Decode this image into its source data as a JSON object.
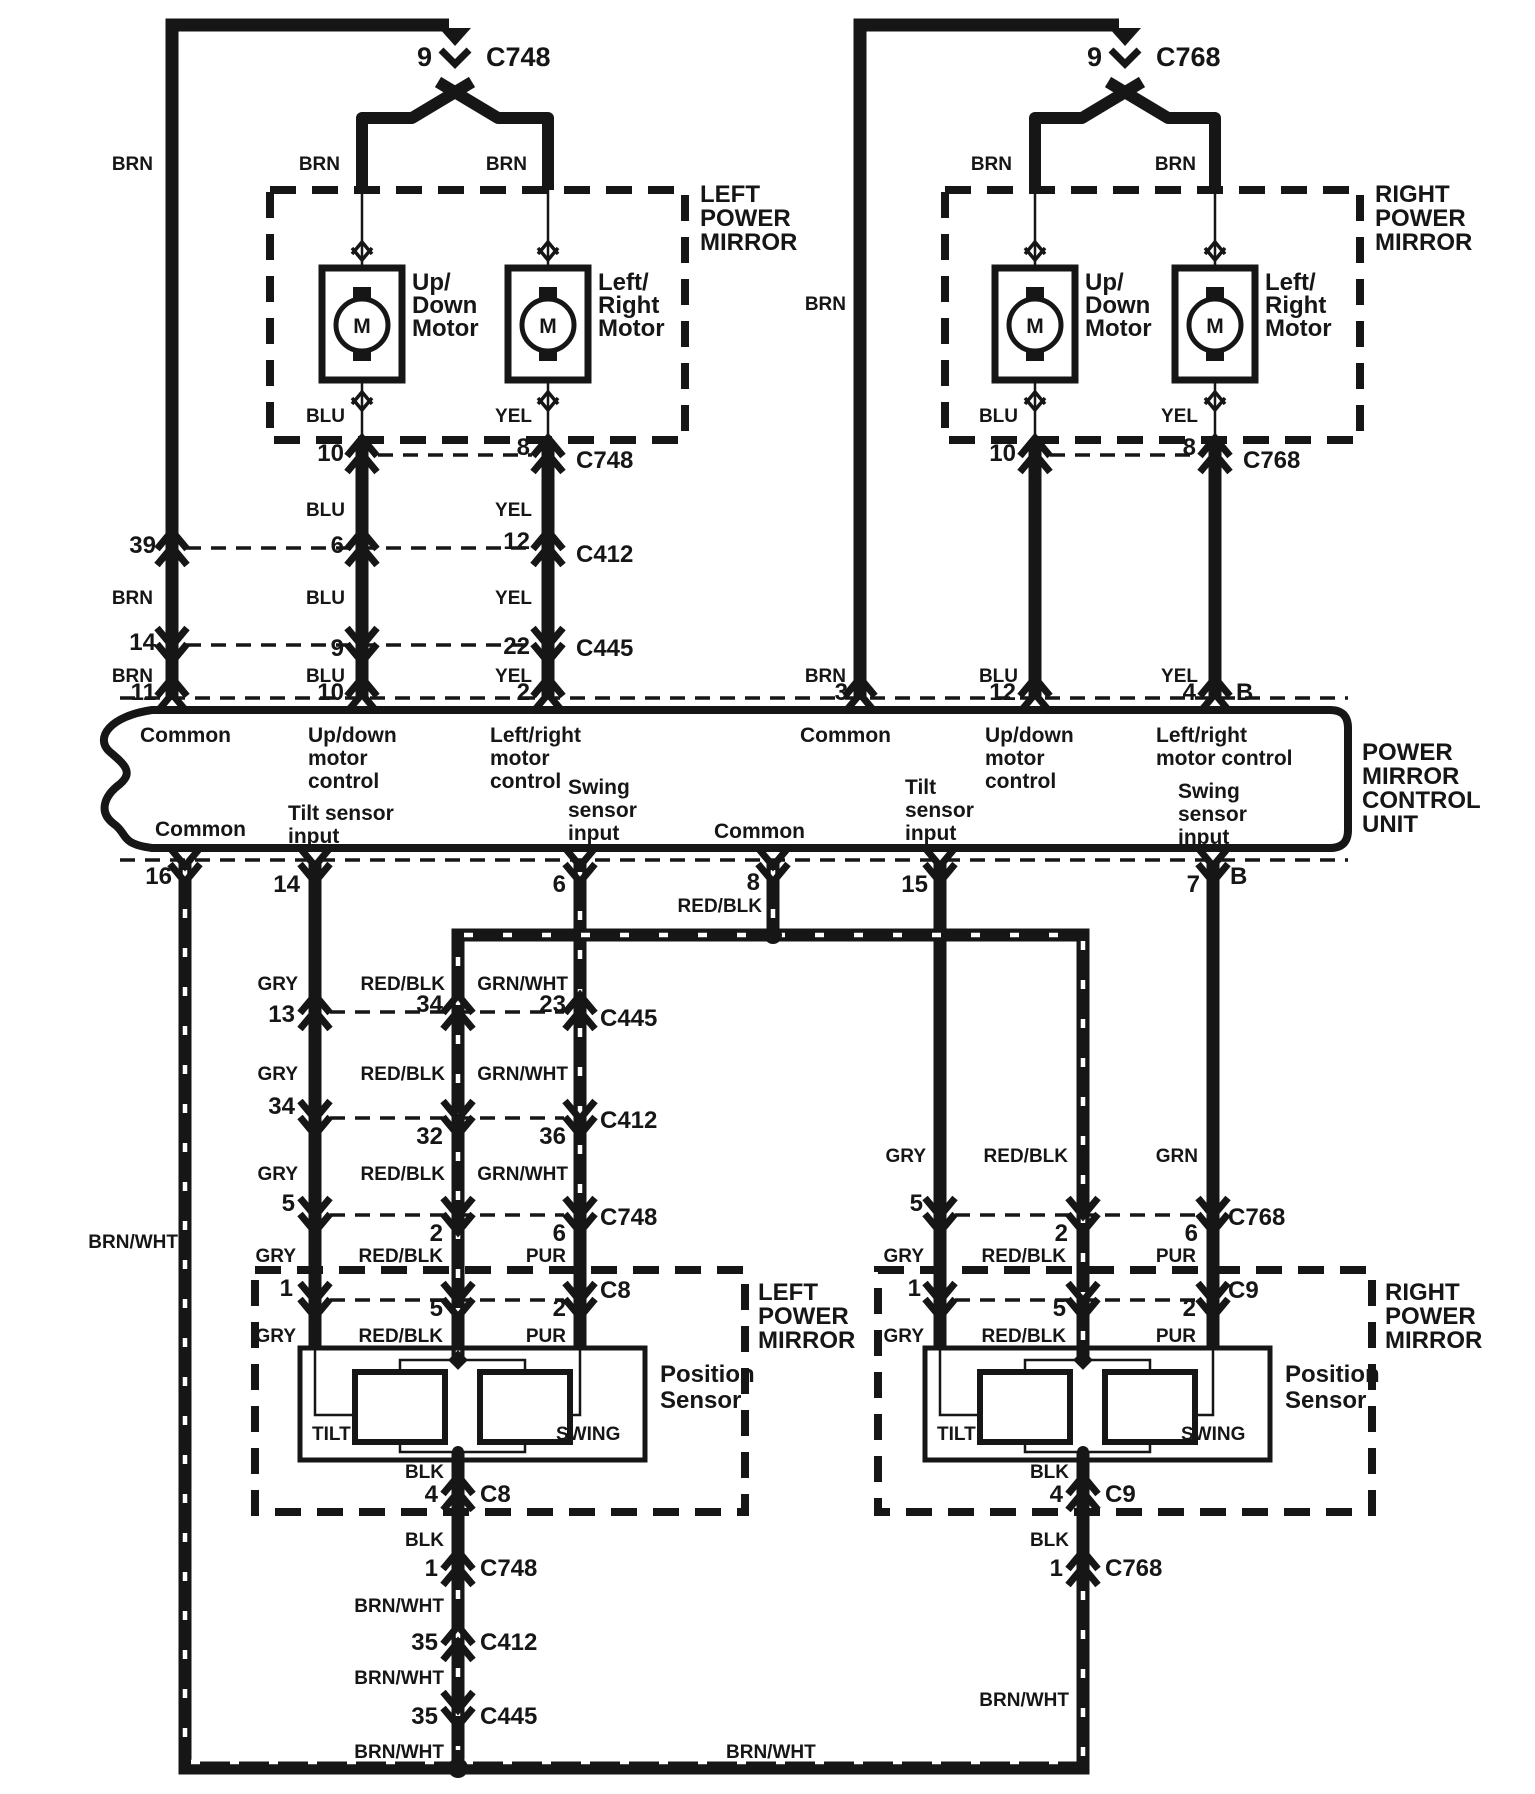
{
  "left_top": {
    "pin": "9",
    "connector": "C748",
    "feed_color": "BRN",
    "branch_left_color": "BRN",
    "branch_right_color": "BRN",
    "box_label": [
      "LEFT",
      "POWER",
      "MIRROR"
    ],
    "updown_motor": [
      "Up/",
      "Down",
      "Motor"
    ],
    "leftright_motor": [
      "Left/",
      "Right",
      "Motor"
    ],
    "motor_letter": "M"
  },
  "right_top": {
    "pin": "9",
    "connector": "C768",
    "feed_color": "BRN",
    "branch_left_color": "BRN",
    "branch_right_color": "BRN",
    "box_label": [
      "RIGHT",
      "POWER",
      "MIRROR"
    ],
    "updown_motor": [
      "Up/",
      "Down",
      "Motor"
    ],
    "leftright_motor": [
      "Left/",
      "Right",
      "Motor"
    ],
    "motor_letter": "M"
  },
  "left_rows": {
    "c748": {
      "colors": [
        "BLU",
        "YEL"
      ],
      "pins": [
        "10",
        "8"
      ],
      "name": "C748"
    },
    "c412": {
      "colors": [
        "BLU",
        "YEL"
      ],
      "pins": [
        "39",
        "6",
        "12"
      ],
      "name": "C412"
    },
    "c445": {
      "colors": [
        "BRN",
        "BLU",
        "YEL"
      ],
      "pins": [
        "14",
        "9",
        "22"
      ],
      "name": "C445"
    },
    "unit": {
      "colors": [
        "BRN",
        "BLU",
        "YEL"
      ],
      "pins": [
        "11",
        "10",
        "2"
      ]
    }
  },
  "right_rows": {
    "c768": {
      "colors": [
        "BLU",
        "YEL"
      ],
      "pins": [
        "10",
        "8"
      ],
      "name": "C768"
    },
    "unit": {
      "colors": [
        "BRN",
        "BLU",
        "YEL"
      ],
      "pins": [
        "3",
        "12",
        "4"
      ],
      "suffix": "B"
    }
  },
  "unit": {
    "title": [
      "POWER",
      "MIRROR",
      "CONTROL",
      "UNIT"
    ],
    "top_fn": {
      "common_l": "Common",
      "updown_l": [
        "Up/down",
        "motor",
        "control"
      ],
      "leftright_l": [
        "Left/right",
        "motor",
        "control"
      ],
      "common_r": "Common",
      "updown_r": [
        "Up/down",
        "motor",
        "control"
      ],
      "leftright_r": [
        "Left/right",
        "motor control"
      ]
    },
    "bottom_fn": {
      "common_l": "Common",
      "tilt_l": [
        "Tilt sensor",
        "input"
      ],
      "swing_l": [
        "Swing",
        "sensor",
        "input"
      ],
      "common_m": "Common",
      "tilt_r": [
        "Tilt",
        "sensor",
        "input"
      ],
      "swing_r": [
        "Swing",
        "sensor",
        "input"
      ]
    },
    "bottom_pins": {
      "p16": "16",
      "p14": "14",
      "p6": "6",
      "p8": "8",
      "p8_color": "RED/BLK",
      "p15": "15",
      "p7": "7",
      "suffix": "B"
    }
  },
  "left_lower": {
    "feed_color": "BRN/WHT",
    "c445": {
      "colors": [
        "GRY",
        "RED/BLK",
        "GRN/WHT"
      ],
      "pins": [
        "13",
        "34",
        "23"
      ],
      "name": "C445"
    },
    "c412": {
      "colors": [
        "GRY",
        "RED/BLK",
        "GRN/WHT"
      ],
      "pins": [
        "34",
        "32",
        "36"
      ],
      "name": "C412"
    },
    "c748": {
      "colors": [
        "GRY",
        "RED/BLK",
        "GRN/WHT"
      ],
      "pins": [
        "5",
        "2",
        "6"
      ],
      "name": "C748"
    },
    "c8": {
      "colors": [
        "GRY",
        "RED/BLK",
        "PUR"
      ],
      "pins": [
        "1",
        "5",
        "2"
      ],
      "name": "C8"
    },
    "inner_colors": [
      "GRY",
      "RED/BLK",
      "PUR"
    ],
    "box_label": [
      "LEFT",
      "POWER",
      "MIRROR"
    ],
    "sensor_label": [
      "Position",
      "Sensor"
    ],
    "tilt": "TILT",
    "swing": "SWING",
    "chain": {
      "c8": {
        "color": "BLK",
        "pin": "4",
        "name": "C8"
      },
      "c748": {
        "color": "BLK",
        "pin": "1",
        "name": "C748"
      },
      "c412": {
        "color": "BRN/WHT",
        "pin": "35",
        "name": "C412"
      },
      "c445": {
        "color": "BRN/WHT",
        "pin": "35",
        "name": "C445"
      },
      "tail_color": "BRN/WHT"
    }
  },
  "right_lower": {
    "c768": {
      "colors": [
        "GRY",
        "RED/BLK",
        "GRN"
      ],
      "pins": [
        "5",
        "2",
        "6"
      ],
      "name": "C768"
    },
    "c9": {
      "colors": [
        "GRY",
        "RED/BLK",
        "PUR"
      ],
      "pins": [
        "1",
        "5",
        "2"
      ],
      "name": "C9"
    },
    "inner_colors": [
      "GRY",
      "RED/BLK",
      "PUR"
    ],
    "box_label": [
      "RIGHT",
      "POWER",
      "MIRROR"
    ],
    "sensor_label": [
      "Position",
      "Sensor"
    ],
    "tilt": "TILT",
    "swing": "SWING",
    "chain": {
      "c9": {
        "color": "BLK",
        "pin": "4",
        "name": "C9"
      },
      "c768": {
        "color": "BLK",
        "pin": "1",
        "name": "C768"
      },
      "tail_color": "BRN/WHT"
    }
  },
  "bus_label": "BRN/WHT",
  "ink_color": "#161616"
}
